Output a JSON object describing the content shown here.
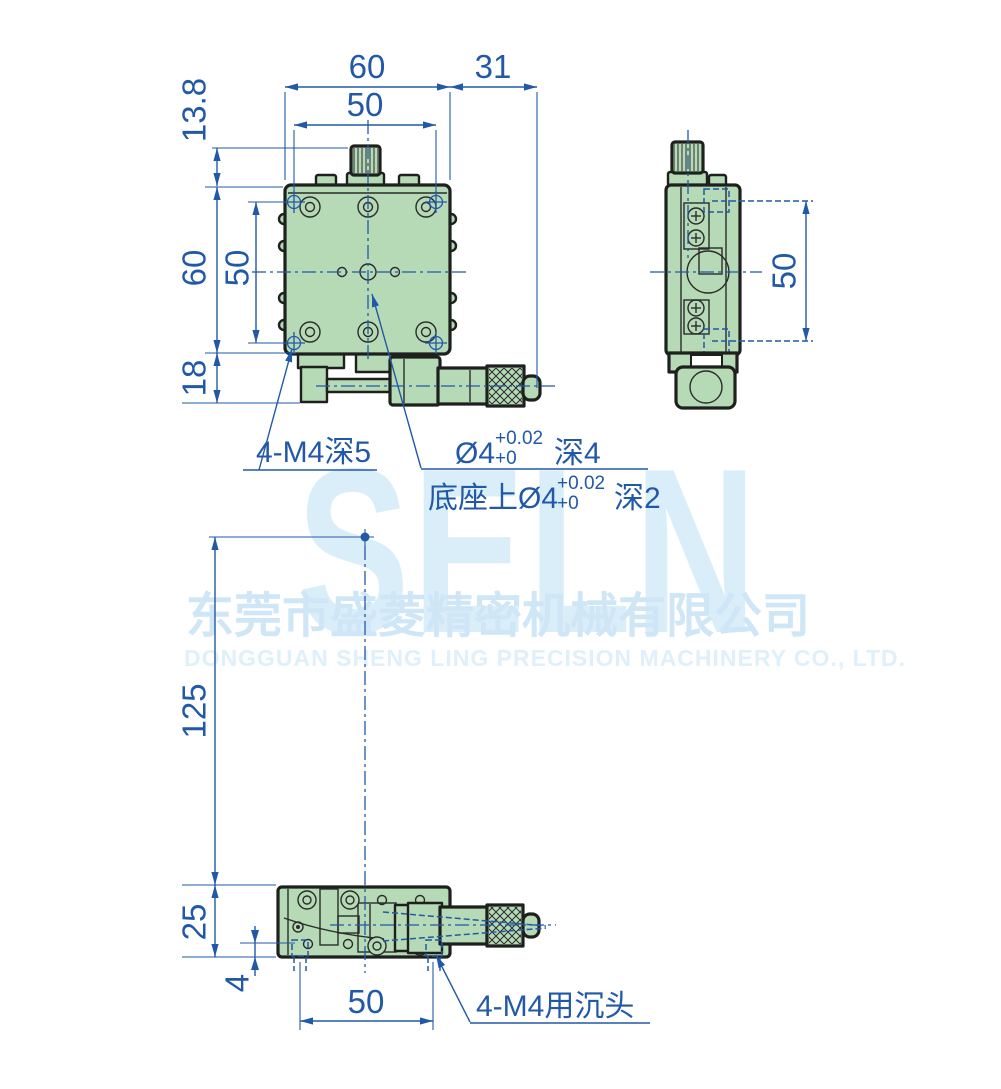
{
  "watermark": {
    "logo": "SELN",
    "company_cn": "东莞市盛菱精密机械有限公司",
    "company_en": "DONGGUAN SHENG LING PRECISION MACHINERY CO., LTD."
  },
  "dimensions": {
    "top_width": "60",
    "top_offset": "31",
    "top_hole_span": "50",
    "knob_height": "13.8",
    "left_height": "60",
    "left_hole_span": "50",
    "base_height": "18",
    "side_hole_span": "50",
    "center_to_base": "125",
    "bottom_height": "25",
    "bottom_recess": "4",
    "bottom_hole_span": "50"
  },
  "annotations": {
    "corner_thread": "4-M4深5",
    "center_hole_dia": "Ø4",
    "center_hole_tol_upper": "+0.02",
    "center_hole_tol_lower": "+0",
    "center_hole_depth": "深4",
    "base_hole_label": "底座上Ø4",
    "base_hole_tol_upper": "+0.02",
    "base_hole_tol_lower": "+0",
    "base_hole_depth": "深2",
    "counterbore": "4-M4用沉头"
  },
  "colors": {
    "dimension_blue": "#2159a8",
    "body_green": "#b6d9b6",
    "outline_dark": "#1e201e",
    "watermark_blue": "#d9ecf9"
  }
}
